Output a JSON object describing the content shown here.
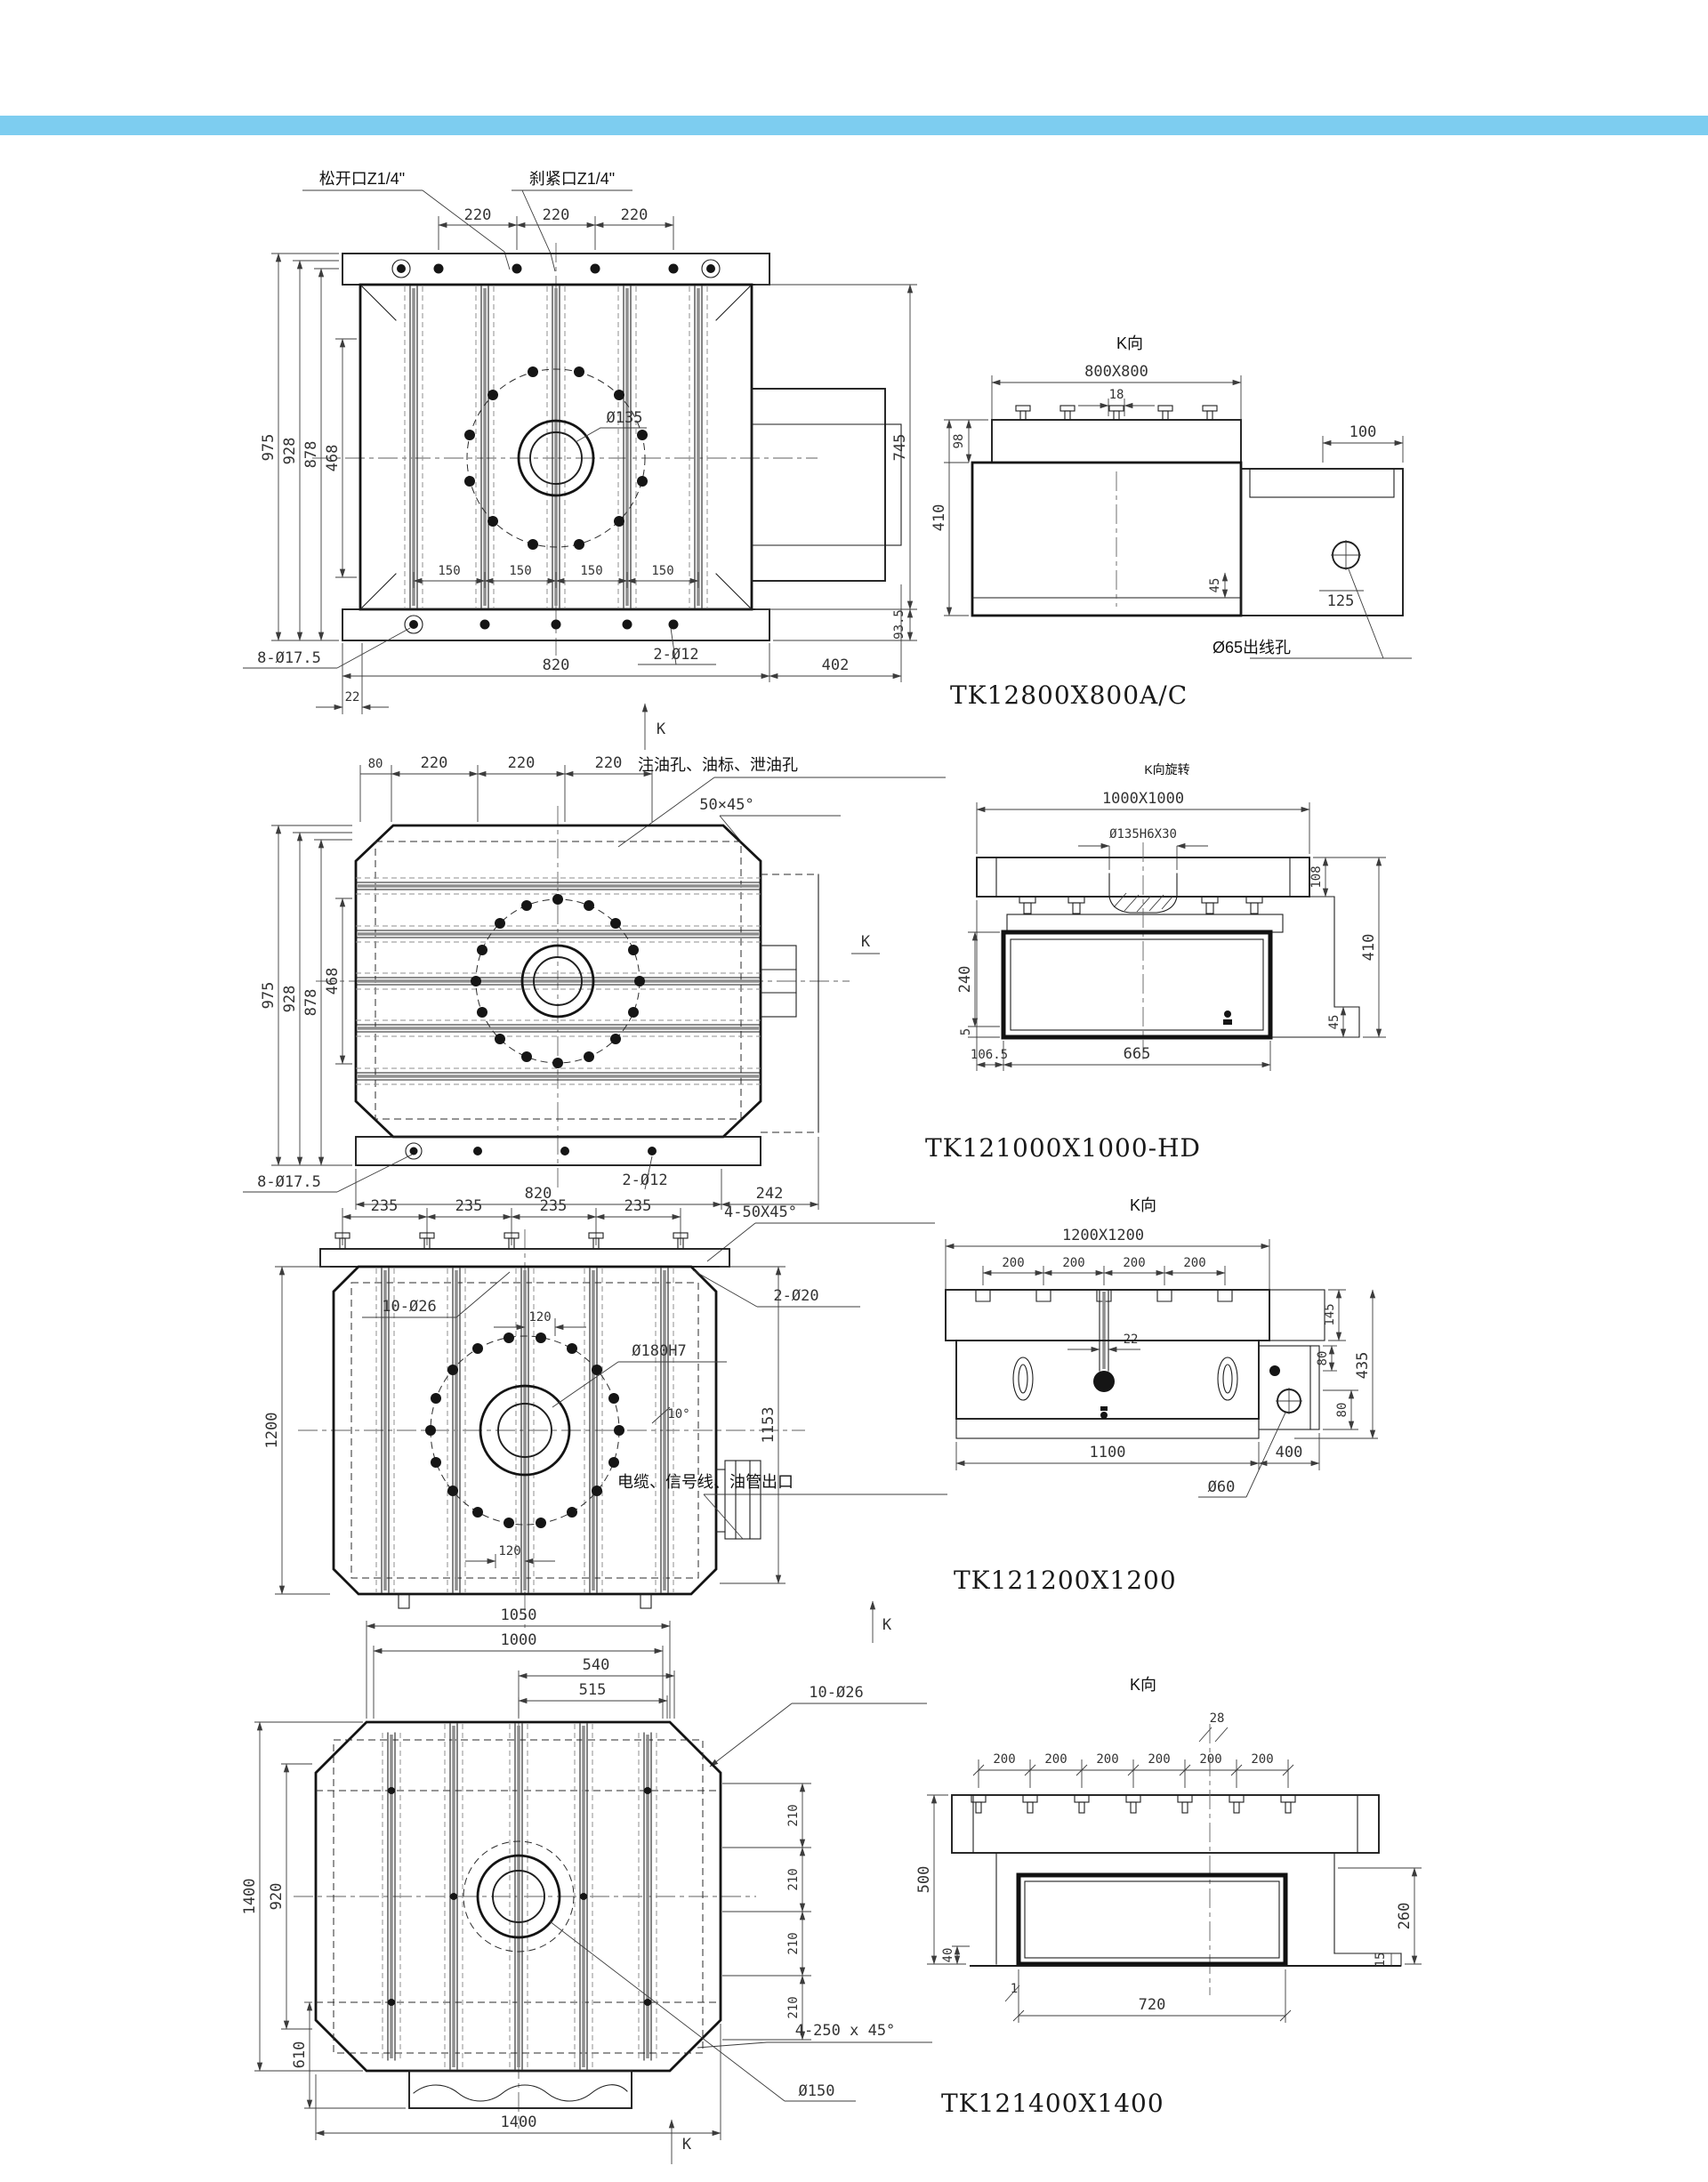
{
  "page": {
    "accent_bar_color": "#7dcdf0",
    "background_color": "#ffffff"
  },
  "drawings": [
    {
      "model": "TK12800X800A/C",
      "front": {
        "callout_loosen": "松开口Z1/4\"",
        "callout_clamp": "刹紧口Z1/4\"",
        "top_dims": [
          "220",
          "220",
          "220"
        ],
        "left_dims": [
          "975",
          "928",
          "878",
          "468"
        ],
        "slot_dims": [
          "150",
          "150",
          "150",
          "150"
        ],
        "dim_820": "820",
        "dim_402": "402",
        "dim_22": "22",
        "dim_745": "745",
        "dim_93_5": "93.5",
        "note_8_holes": "8-Ø17.5",
        "note_2_holes": "2-Ø12",
        "center_bore": "Ø135",
        "k_label": "K"
      },
      "k_view": {
        "title": "K向",
        "table_size": "800X800",
        "dim_18": "18",
        "dim_98": "98",
        "dim_410": "410",
        "dim_45": "45",
        "dim_100": "100",
        "dim_125": "125",
        "wire_note": "Ø65出线孔"
      }
    },
    {
      "model": "TK121000X1000-HD",
      "front": {
        "top_dims": [
          "80",
          "220",
          "220",
          "220"
        ],
        "oil_note": "注油孔、油标、泄油孔",
        "chamfer_note": "50×45°",
        "left_dims": [
          "975",
          "928",
          "878",
          "468"
        ],
        "dim_820": "820",
        "dim_242": "242",
        "note_8_holes": "8-Ø17.5",
        "note_2_holes": "2-Ø12",
        "k_label": "K"
      },
      "k_view": {
        "title": "K向旋转",
        "table_size": "1000X1000",
        "spigot_note": "Ø135H6X30",
        "dim_108": "108",
        "dim_410": "410",
        "dim_45": "45",
        "dim_240": "240",
        "dim_5": "5",
        "dim_106_5": "106.5",
        "dim_665": "665"
      }
    },
    {
      "model": "TK121200X1200",
      "front": {
        "top_dims": [
          "235",
          "235",
          "235",
          "235"
        ],
        "chamfer_note": "4-50X45°",
        "note_10_holes": "10-Ø26",
        "dim_120_top": "120",
        "note_2_holes": "2-Ø20",
        "center_bore": "Ø180H7",
        "angle_note": "10°",
        "dim_1200": "1200",
        "dim_1153": "1153",
        "cable_note": "电缆、信号线、油管出口",
        "dim_120_bottom": "120",
        "k_label": "K"
      },
      "k_view": {
        "title": "K向",
        "table_size": "1200X1200",
        "top_dims": [
          "200",
          "200",
          "200",
          "200"
        ],
        "dim_22": "22",
        "dim_145": "145",
        "dim_435": "435",
        "dim_80_upper": "80",
        "dim_80_lower": "80",
        "dim_1100": "1100",
        "dim_400": "400",
        "wire_note": "Ø60"
      }
    },
    {
      "model": "TK121400X1400",
      "front": {
        "dim_1050": "1050",
        "dim_1000": "1000",
        "dim_540": "540",
        "dim_515": "515",
        "note_10_holes": "10-Ø26",
        "right_dims": [
          "210",
          "210",
          "210",
          "210"
        ],
        "dim_1400_left": "1400",
        "dim_920": "920",
        "dim_610": "610",
        "dim_1400_bottom": "1400",
        "chamfer_note": "4-250 x 45°",
        "center_bore": "Ø150",
        "k_label": "K"
      },
      "k_view": {
        "title": "K向",
        "dim_28": "28",
        "top_dims": [
          "200",
          "200",
          "200",
          "200",
          "200",
          "200"
        ],
        "dim_500": "500",
        "dim_40": "40",
        "dim_weld": "1",
        "dim_720": "720",
        "dim_15": "15",
        "dim_260": "260"
      }
    }
  ]
}
